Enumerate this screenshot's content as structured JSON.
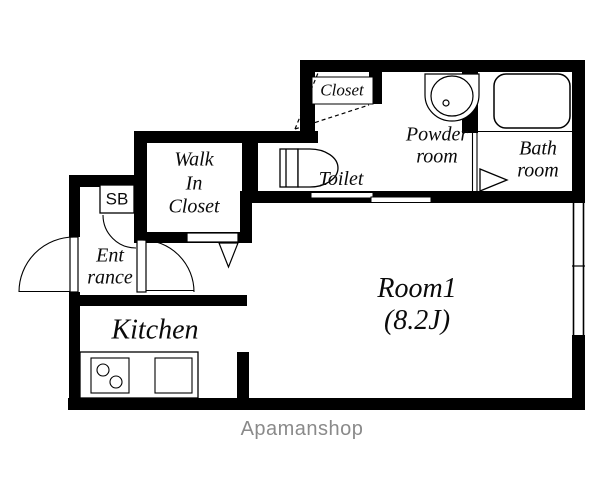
{
  "floorplan": {
    "rooms": {
      "closet": {
        "name": "Closet"
      },
      "powder_room": {
        "line1": "Powder",
        "line2": "room"
      },
      "bath_room": {
        "line1": "Bath",
        "line2": "room"
      },
      "walk_in_closet": {
        "line1": "Walk",
        "line2": "In",
        "line3": "Closet"
      },
      "toilet": {
        "name": "Toilet"
      },
      "shoe_box": {
        "name": "SB"
      },
      "entrance": {
        "line1": "Ent",
        "line2": "rance"
      },
      "kitchen": {
        "name": "Kitchen"
      },
      "room1": {
        "name": "Room1",
        "size_label": "(8.2J)"
      }
    },
    "branding": {
      "logo": "Apamanshop"
    },
    "colors": {
      "wall": "#000000",
      "background": "#ffffff",
      "logo": "#8a8a8a"
    }
  }
}
